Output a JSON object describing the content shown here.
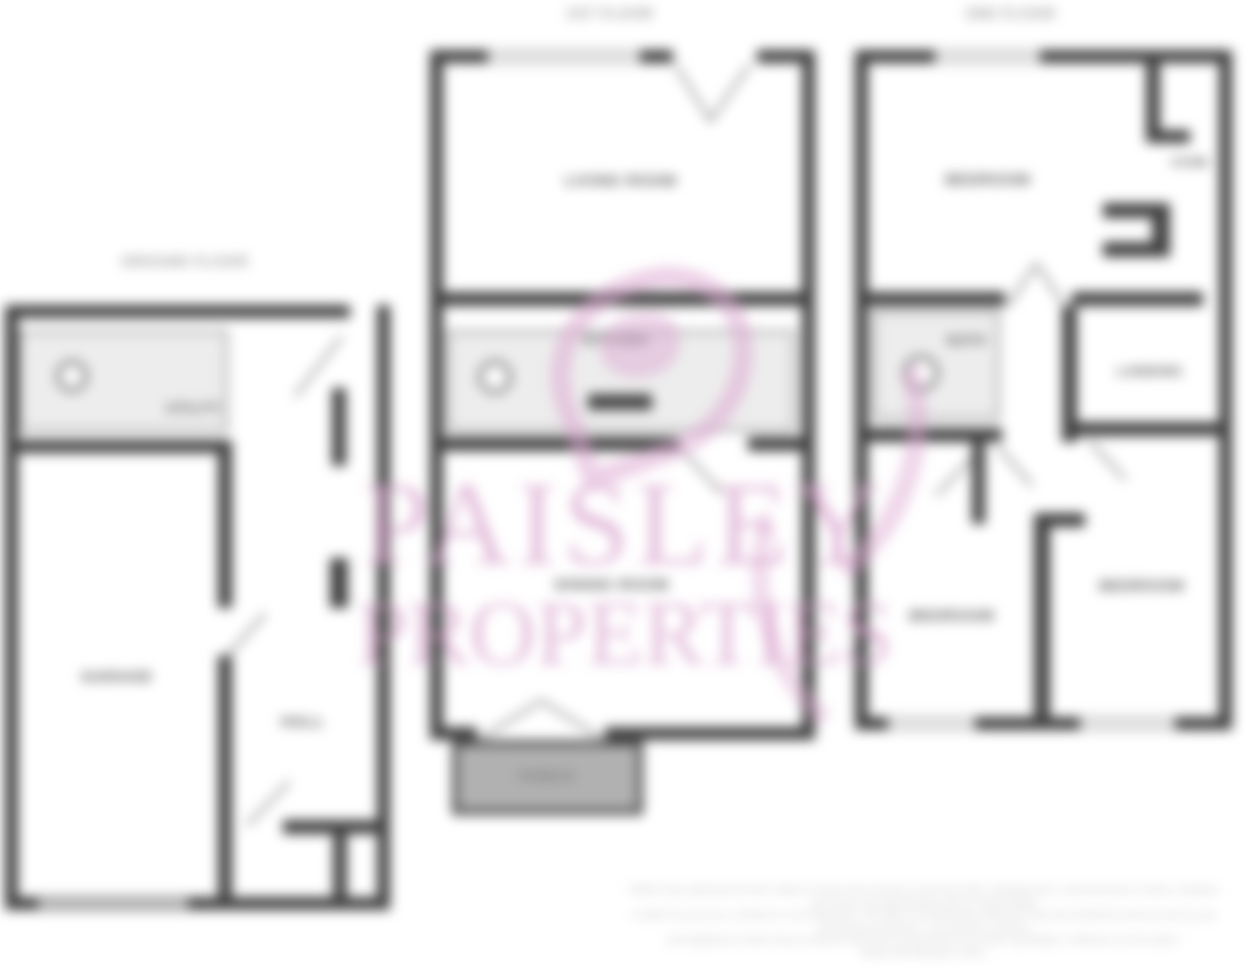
{
  "plan": {
    "floors": {
      "left": "GROUND FLOOR",
      "middle": "1ST FLOOR",
      "right": "2ND FLOOR"
    },
    "rooms": {
      "utility": "UTILITY",
      "garage": "GARAGE",
      "hall": "HALL",
      "living": "LIVING ROOM",
      "kitchen": "KITCHEN",
      "dining": "DINING ROOM",
      "porch": "PORCH",
      "bedroom1": "BEDROOM",
      "store": "STORE",
      "bath": "BATH",
      "landing": "LANDING",
      "bedroom2": "BEDROOM",
      "bedroom3": "BEDROOM"
    }
  },
  "watermark": {
    "line1": "PAISLEY",
    "line2": "PROPERTIES",
    "color": "#d498c7"
  },
  "disclaimer": {
    "line1": "Whilst every attempt has been made to ensure the accuracy of the floor plan contained here, measurements of doors, windows and rooms are approximate and no responsibility",
    "line2": "is taken for any error, omission or mis-statement. This plan is for illustrative purposes only and should be used as such by any prospective purchaser. The services, systems",
    "line3": "and appliances shown have not been tested and no guarantee as to their operability or efficiency can be given.",
    "line4": "Made with Metropix ©2021"
  },
  "colors": {
    "wall": "#414141",
    "fixture_fill": "#ededed",
    "fixture_border": "#9b9b9b",
    "porch_fill": "#b1b1b1",
    "room_label": "#4c4c4c",
    "floor_label": "#8f8f8f",
    "disclaimer_text": "#bdbdbd",
    "watermark_pink": "#d498c7"
  }
}
